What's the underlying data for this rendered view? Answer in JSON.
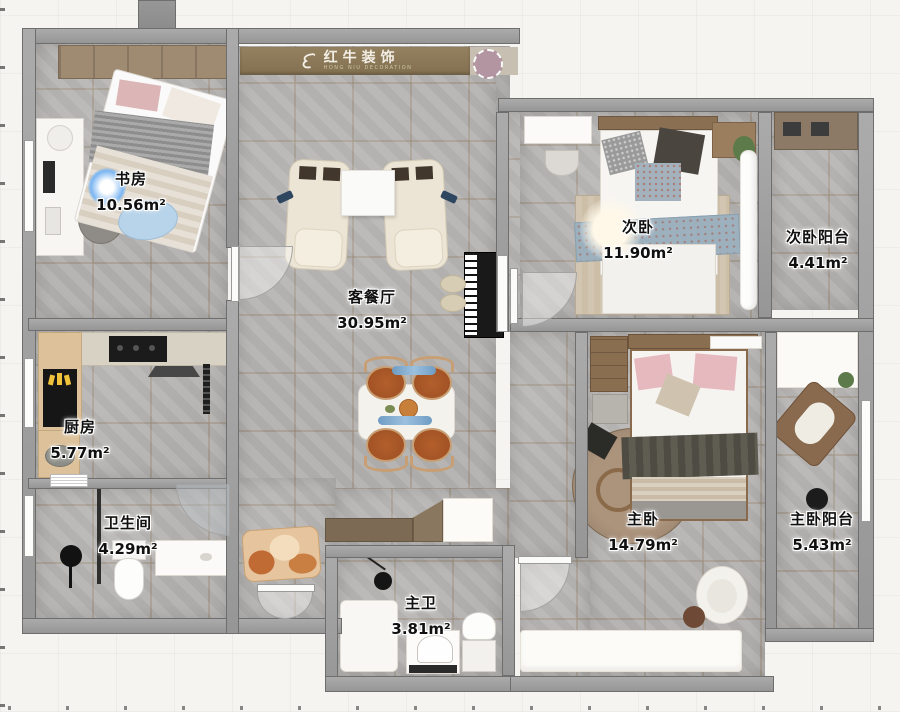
{
  "brand": {
    "logo_text": "红牛装饰",
    "logo_sub": "HONG NIU DECORATION"
  },
  "rooms": [
    {
      "key": "study",
      "name": "书房",
      "area": "10.56m²"
    },
    {
      "key": "living-dining",
      "name": "客餐厅",
      "area": "30.95m²"
    },
    {
      "key": "second-bedroom",
      "name": "次卧",
      "area": "11.90m²"
    },
    {
      "key": "second-balcony",
      "name": "次卧阳台",
      "area": "4.41m²"
    },
    {
      "key": "kitchen",
      "name": "厨房",
      "area": "5.77m²"
    },
    {
      "key": "bathroom",
      "name": "卫生间",
      "area": "4.29m²"
    },
    {
      "key": "master-bath",
      "name": "主卫",
      "area": "3.81m²"
    },
    {
      "key": "master-bedroom",
      "name": "主卧",
      "area": "14.79m²"
    },
    {
      "key": "master-balcony",
      "name": "主卧阳台",
      "area": "5.43m²"
    }
  ],
  "colors": {
    "page_bg": "#f5f4f1",
    "wall": "#9b9b9b",
    "floor_tile": "#b4b2b0",
    "wood": "#8a6f55",
    "banner": "#8b7a5e",
    "label_text": "#101010",
    "label_halo": "#ffffff",
    "accent_glow_blue": "#7ab5f2"
  }
}
